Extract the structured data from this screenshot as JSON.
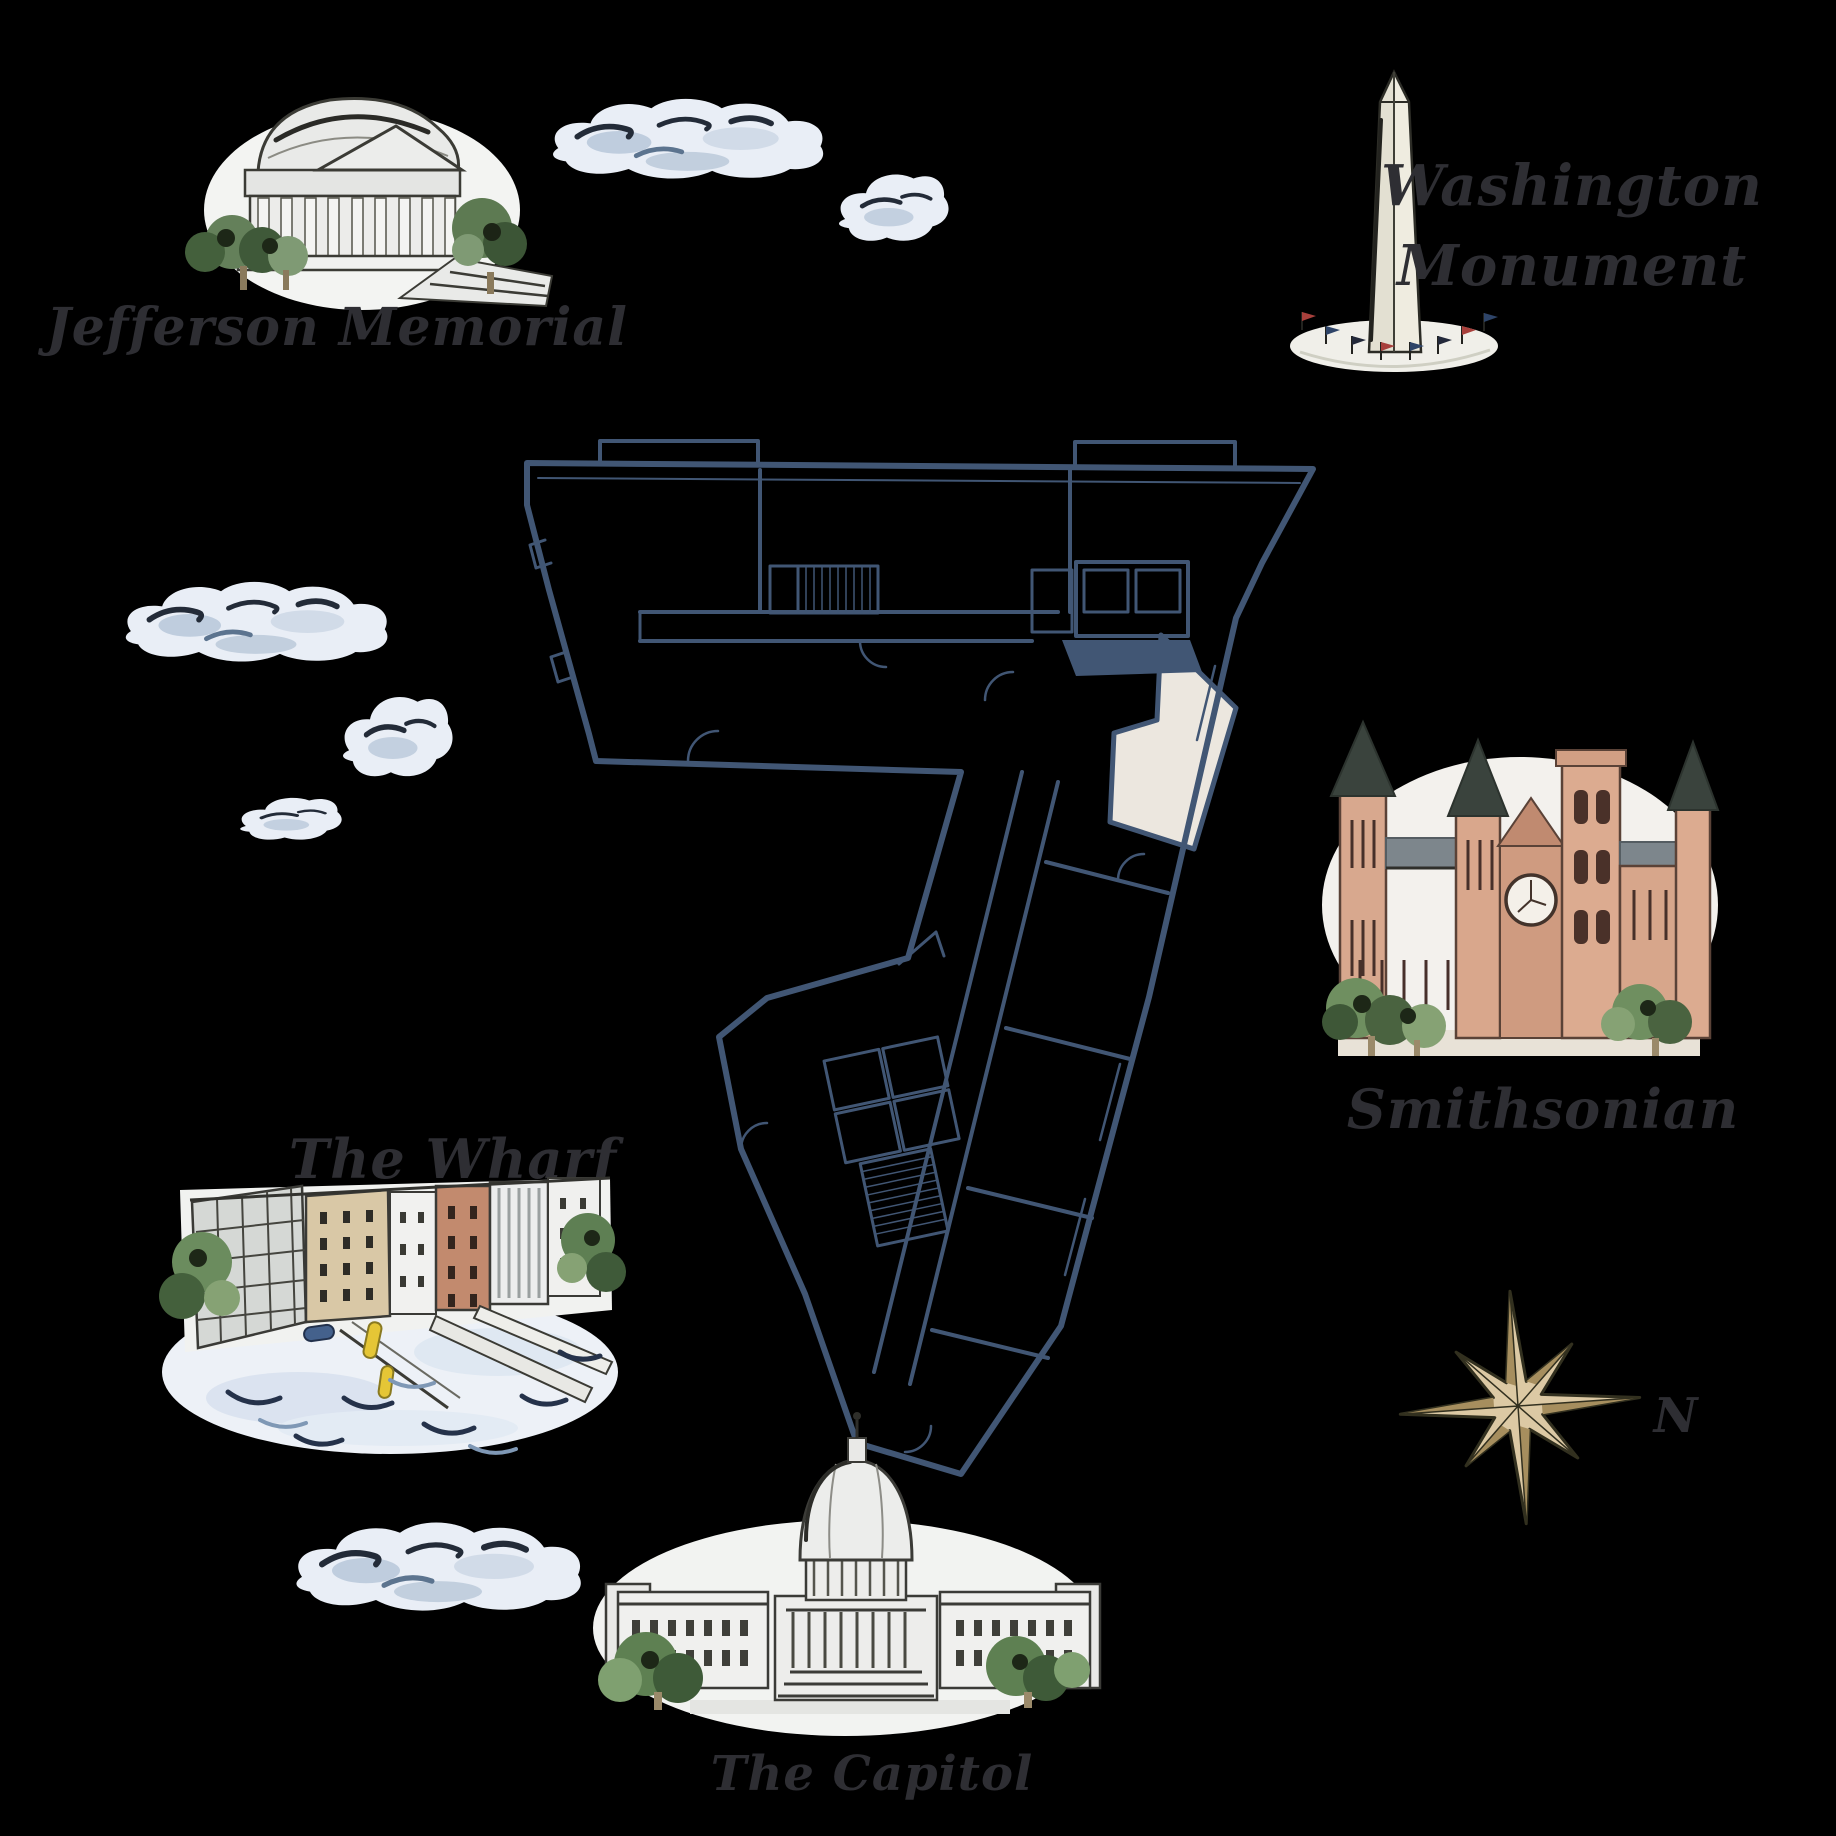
{
  "page_type": "illustrated-landmark-map-with-floor-plan",
  "background_color": "#000000",
  "floor_plan": {
    "wall_color": "#415674",
    "highlighted_unit_color": "#ece7df"
  },
  "landmarks": {
    "jefferson": {
      "label": "Jefferson Memorial"
    },
    "washington_monument": {
      "label_line1": "Washington",
      "label_line2": "Monument"
    },
    "smithsonian": {
      "label": "Smithsonian"
    },
    "wharf": {
      "label": "The Wharf"
    },
    "capitol": {
      "label": "The Capitol"
    }
  },
  "compass": {
    "north_label": "N"
  },
  "palette": {
    "label_ink": "#2e2e33",
    "cloud_fill": "#e9eef6",
    "cloud_accent": "#9fb4cc",
    "cloud_ink": "#232b38",
    "compass_gold": "#dcc9a4",
    "tree_green_dark": "#3e5a38",
    "tree_green_mid": "#5e8052",
    "tree_green_light": "#86a274",
    "castle_salmon": "#d8a78c",
    "monument_stone": "#edebdf",
    "water_blue": "#edf1f7",
    "kayak_yellow": "#e5c636",
    "flag_red": "#a8403c",
    "flag_blue": "#2e4468"
  }
}
